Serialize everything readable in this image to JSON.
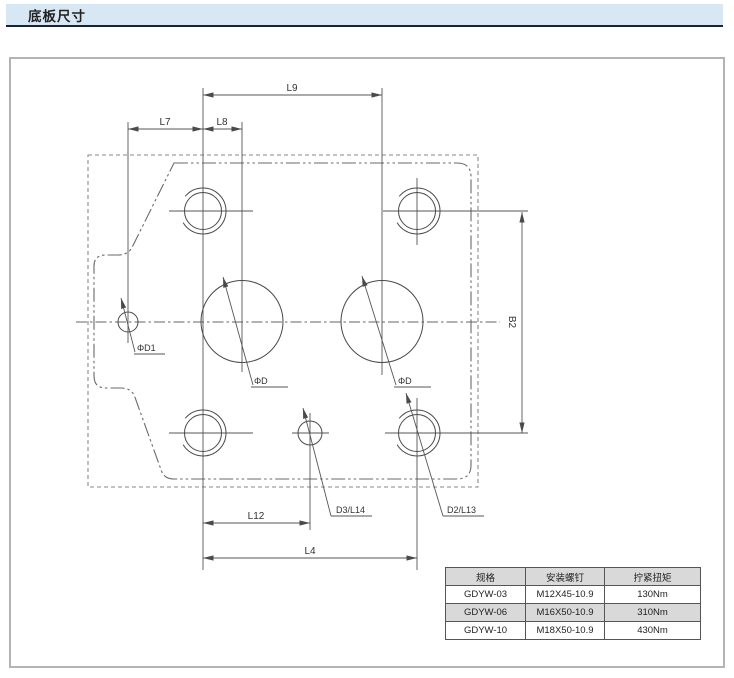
{
  "header": {
    "title": "底板尺寸"
  },
  "drawing": {
    "labels": {
      "l9": "L9",
      "l7": "L7",
      "l8": "L8",
      "b2": "B2",
      "phi_d1": "ΦD1",
      "phi_d_left": "ΦD",
      "phi_d_right": "ΦD",
      "d3_l14": "D3/L14",
      "d2_l13": "D2/L13",
      "l12": "L12",
      "l4": "L4"
    }
  },
  "table": {
    "headers": [
      "规格",
      "安装螺钉",
      "拧紧扭矩"
    ],
    "rows": [
      [
        "GDYW-03",
        "M12X45-10.9",
        "130Nm"
      ],
      [
        "GDYW-06",
        "M16X50-10.9",
        "310Nm"
      ],
      [
        "GDYW-10",
        "M18X50-10.9",
        "430Nm"
      ]
    ]
  },
  "colors": {
    "section_header_bg": "#d7e7f4",
    "section_header_rule": "#1b2330",
    "drawing_line": "#4a4a4a",
    "table_stripe_bg": "#d9d9d9",
    "table_border": "#555555"
  }
}
